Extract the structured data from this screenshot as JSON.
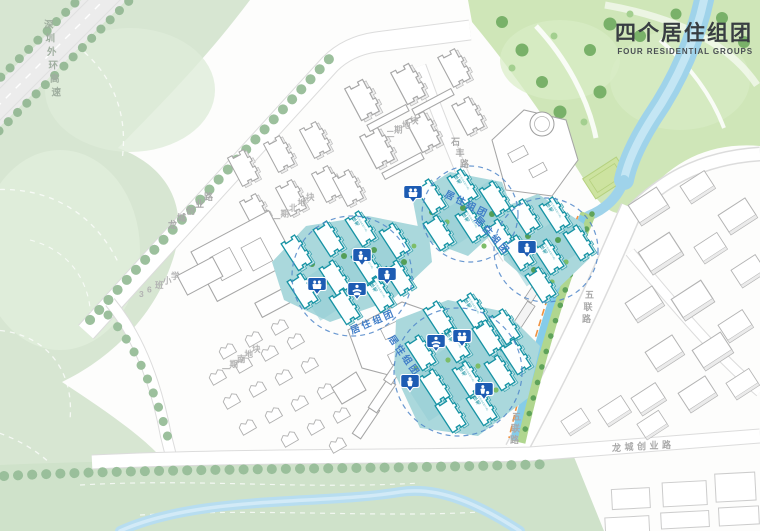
{
  "title": {
    "zh": "四个居住组团",
    "en": "FOUR RESIDENTIAL GROUPS"
  },
  "roads": {
    "expressway": "深圳外环高速",
    "longcheng_chuangye": "龙城创业路",
    "shifeng": "石丰路",
    "wulian": "五联路"
  },
  "parcels": {
    "phase2": "二期地块",
    "phase1_north": "一期北地块",
    "phase1_south": "一期南地块",
    "school": "36班小学"
  },
  "clusters": {
    "label": "居住组团",
    "count": 4
  },
  "building": {
    "zh": "住宅",
    "en": "RESIDENTIAL"
  },
  "map_pins": {
    "icon_types": [
      "community-people-icon",
      "basketball-icon",
      "runner-icon",
      "yoga-icon"
    ]
  },
  "colors": {
    "highlight_teal": "#1693a4",
    "cluster_ground": "#aad8dc",
    "circle_blue": "#4f86c9",
    "pin_blue": "#1d5cb3",
    "hill_green": "#d7e6d2",
    "park_green": "#cfe6b8",
    "water_blue": "#9fd3ea",
    "title_text": "#383d42"
  }
}
